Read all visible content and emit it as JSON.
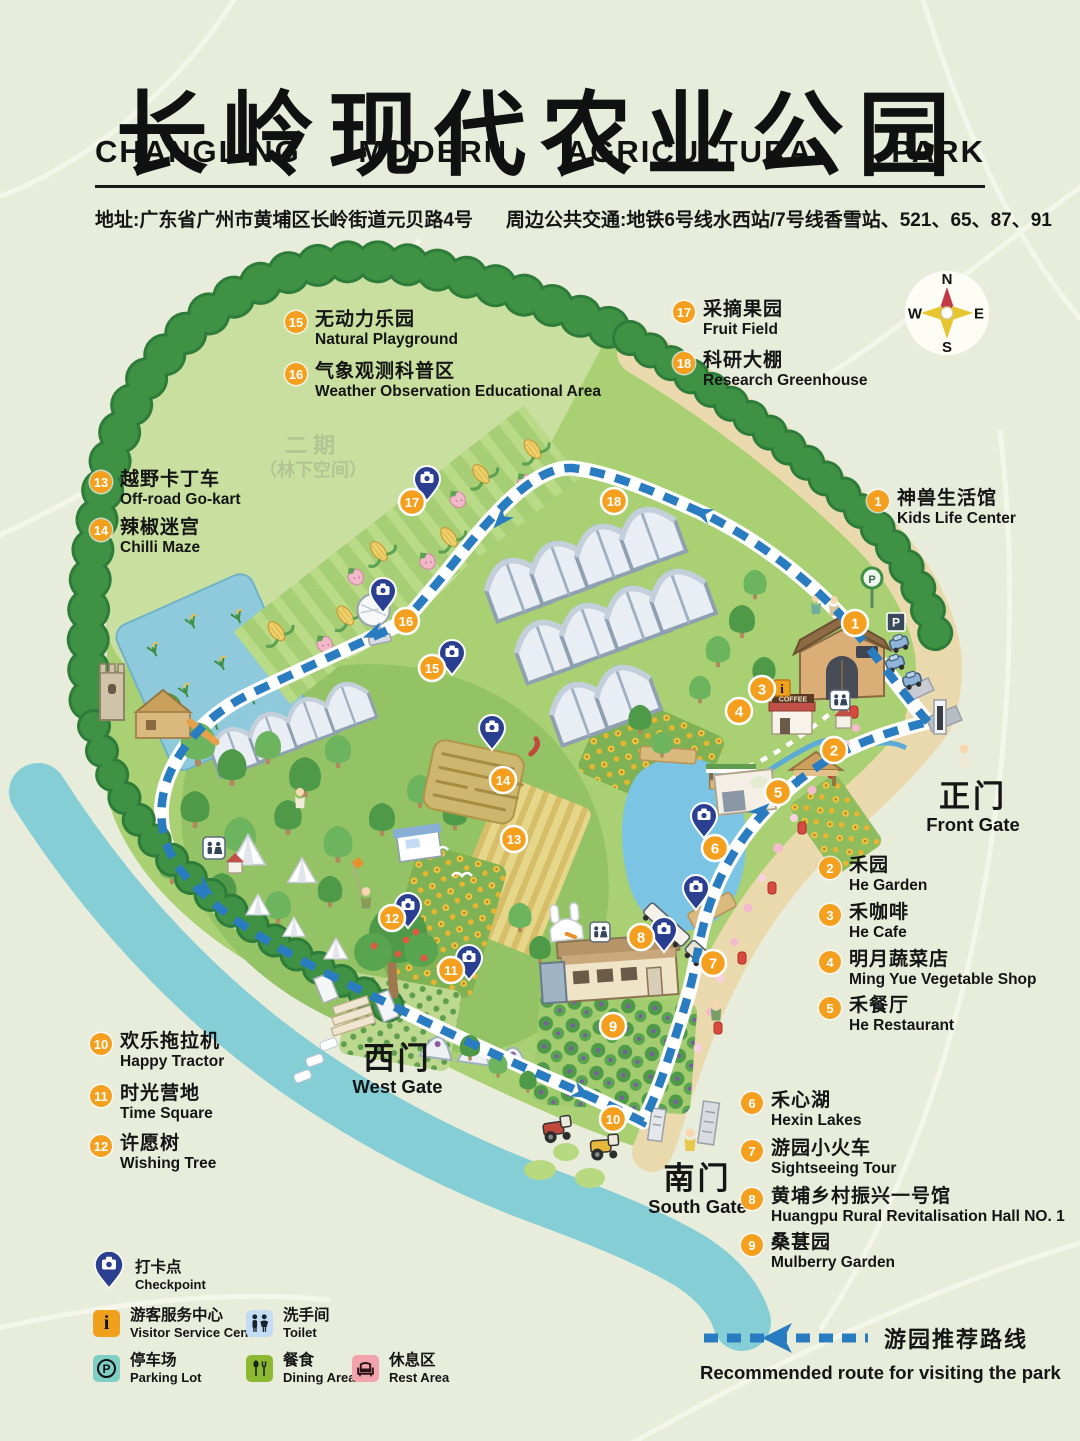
{
  "header": {
    "title_zh": "长岭现代农业公园",
    "title_en_words": [
      "CHANGLING",
      "MODERN",
      "AGRICULTURAL",
      "PARK"
    ],
    "address": "地址:广东省广州市黄埔区长岭街道元贝路4号",
    "transit": "周边公共交通:地铁6号线水西站/7号线香雪站、521、65、87、91"
  },
  "compass": {
    "n": "N",
    "e": "E",
    "s": "S",
    "w": "W"
  },
  "phase2": {
    "line1": "二期",
    "line2": "（林下空间）"
  },
  "gates": {
    "front": {
      "zh": "正门",
      "en": "Front Gate"
    },
    "west": {
      "zh": "西门",
      "en": "West Gate"
    },
    "south": {
      "zh": "南门",
      "en": "South Gate"
    }
  },
  "legend_items": [
    {
      "num": "1",
      "zh": "神兽生活馆",
      "en": "Kids Life Center"
    },
    {
      "num": "2",
      "zh": "禾园",
      "en": "He Garden"
    },
    {
      "num": "3",
      "zh": "禾咖啡",
      "en": "He Cafe"
    },
    {
      "num": "4",
      "zh": "明月蔬菜店",
      "en": "Ming Yue Vegetable Shop"
    },
    {
      "num": "5",
      "zh": "禾餐厅",
      "en": "He Restaurant"
    },
    {
      "num": "6",
      "zh": "禾心湖",
      "en": "Hexin Lakes"
    },
    {
      "num": "7",
      "zh": "游园小火车",
      "en": "Sightseeing Tour"
    },
    {
      "num": "8",
      "zh": "黄埔乡村振兴一号馆",
      "en": "Huangpu Rural Revitalisation Hall NO. 1"
    },
    {
      "num": "9",
      "zh": "桑葚园",
      "en": "Mulberry Garden"
    },
    {
      "num": "10",
      "zh": "欢乐拖拉机",
      "en": "Happy Tractor"
    },
    {
      "num": "11",
      "zh": "时光营地",
      "en": "Time Square"
    },
    {
      "num": "12",
      "zh": "许愿树",
      "en": "Wishing Tree"
    },
    {
      "num": "13",
      "zh": "越野卡丁车",
      "en": "Off-road Go-kart"
    },
    {
      "num": "14",
      "zh": "辣椒迷宫",
      "en": "Chilli Maze"
    },
    {
      "num": "15",
      "zh": "无动力乐园",
      "en": "Natural Playground"
    },
    {
      "num": "16",
      "zh": "气象观测科普区",
      "en": "Weather Observation Educational Area"
    },
    {
      "num": "17",
      "zh": "采摘果园",
      "en": "Fruit Field"
    },
    {
      "num": "18",
      "zh": "科研大棚",
      "en": "Research Greenhouse"
    }
  ],
  "map_marker_numbers": [
    "1",
    "2",
    "3",
    "4",
    "5",
    "6",
    "7",
    "8",
    "9",
    "10",
    "11",
    "12",
    "13",
    "14",
    "15",
    "16",
    "17",
    "18"
  ],
  "facility_legend": {
    "checkpoint": {
      "zh": "打卡点",
      "en": "Checkpoint"
    },
    "visitor_center": {
      "zh": "游客服务中心",
      "en": "Visitor Service Center"
    },
    "toilet": {
      "zh": "洗手间",
      "en": "Toilet"
    },
    "parking": {
      "zh": "停车场",
      "en": "Parking Lot"
    },
    "dining": {
      "zh": "餐食",
      "en": "Dining Area"
    },
    "rest": {
      "zh": "休息区",
      "en": "Rest Area"
    }
  },
  "route_legend": {
    "zh": "游园推荐路线",
    "en": "Recommended route for visiting the park"
  },
  "icon_glyphs": {
    "info": "i",
    "parking": "P",
    "coffee": "COFFEE"
  },
  "colors": {
    "accent_orange": "#F59F1E",
    "route_blue": "#2A7CC1",
    "pin_blue": "#2B3F90",
    "park_green": "#A9D072",
    "phase2_green": "#C9DF9F",
    "ring_green": "#3F9144",
    "lake_blue": "#7CC4E3",
    "river_teal": "#85CED6",
    "sand": "#EAD9AD",
    "background": "#E8ECDB"
  }
}
